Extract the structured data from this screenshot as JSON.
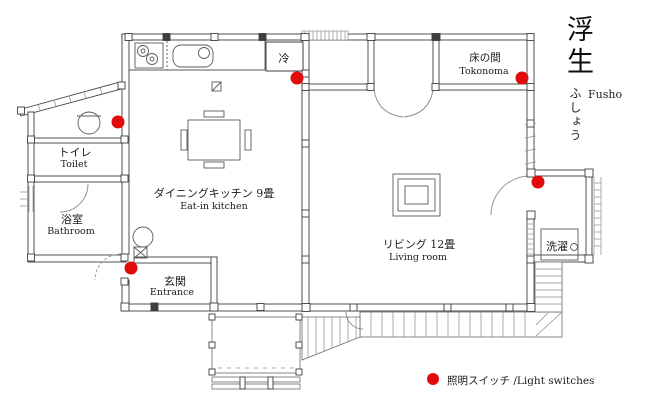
{
  "title": {
    "kanji": "浮生",
    "kana": "ふしょう",
    "romaji": "Fusho"
  },
  "rooms": {
    "toilet": {
      "jp": "トイレ",
      "en": "Toilet"
    },
    "bathroom": {
      "jp": "浴室",
      "en": "Bathroom"
    },
    "kitchen": {
      "jp": "ダイニングキッチン 9畳",
      "en": "Eat-in kitchen"
    },
    "entrance": {
      "jp": "玄関",
      "en": "Entrance"
    },
    "tokonoma": {
      "jp": "床の間",
      "en": "Tokonoma"
    },
    "living": {
      "jp": "リビング 12畳",
      "en": "Living room"
    },
    "refrigerator": {
      "jp": "冷"
    },
    "laundry": {
      "jp": "洗濯"
    }
  },
  "legend": {
    "label": "照明スイッチ /Light switches",
    "marker_color": "#e00b0b"
  },
  "light_switches": {
    "radius": 6.5,
    "count": 5,
    "positions": [
      {
        "x": 118,
        "y": 122
      },
      {
        "x": 297,
        "y": 78
      },
      {
        "x": 522,
        "y": 78
      },
      {
        "x": 538,
        "y": 182
      },
      {
        "x": 131,
        "y": 268
      }
    ]
  },
  "colors": {
    "background": "#ffffff",
    "wall": "#3f3f3f",
    "detail": "#8a8a8a",
    "accent_red": "#e00b0b"
  }
}
